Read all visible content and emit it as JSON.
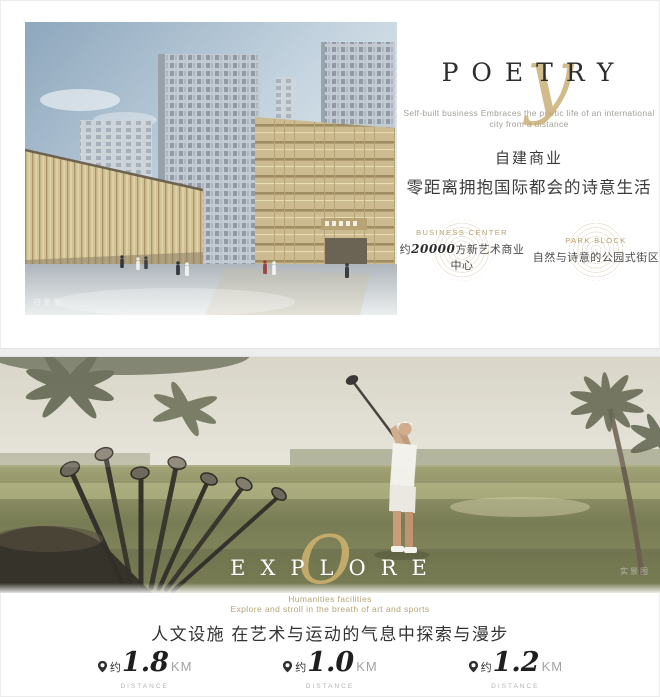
{
  "colors": {
    "accent_gold": "#c2a46a",
    "text_dark": "#3a3a3a",
    "text_gray": "#9b9b9b",
    "photo_green": "#80855c"
  },
  "icons": {
    "distance_pin": "location-pin",
    "badge_emblem": "concentric-ring-rosette"
  },
  "top_section": {
    "watermark": "效果图",
    "poetry": {
      "script_letter": "y",
      "title": "POETRY",
      "subtitle_line1": "Self-built business Embraces the poetic life of an international",
      "subtitle_line2": "city from a distance",
      "heading_line1": "自建商业",
      "heading_line2": "零距离拥抱国际都会的诗意生活"
    },
    "badges": [
      {
        "label": "BUSINESS CENTER",
        "prefix": "约",
        "value": "20000",
        "suffix": "方新艺术商业中心"
      },
      {
        "label": "PARK BLOCK",
        "prefix": "",
        "value": "",
        "suffix": "自然与诗意的公园式街区"
      }
    ]
  },
  "bottom_section": {
    "watermark": "实景图",
    "explore": {
      "script_letter": "O",
      "title": "EXPLORE",
      "subtitle_line1": "Humanities facilities",
      "subtitle_line2": "Explore and stroll in the breath of art and sports",
      "heading": "人文设施 在艺术与运动的气息中探索与漫步"
    },
    "distances": [
      {
        "prefix": "约",
        "value": "1.8",
        "unit": "KM",
        "sublabel": "DISTANCE",
        "caption": "艺术+生活 上海国际舞蹈中心"
      },
      {
        "prefix": "约",
        "value": "1.0",
        "unit": "KM",
        "sublabel": "DISTANCE",
        "caption": "运动+生活 虹桥高尔夫俱乐部"
      },
      {
        "prefix": "约",
        "value": "1.2",
        "unit": "KM",
        "sublabel": "DISTANCE",
        "caption": "探索+生活 上海儿童博物馆"
      }
    ]
  }
}
